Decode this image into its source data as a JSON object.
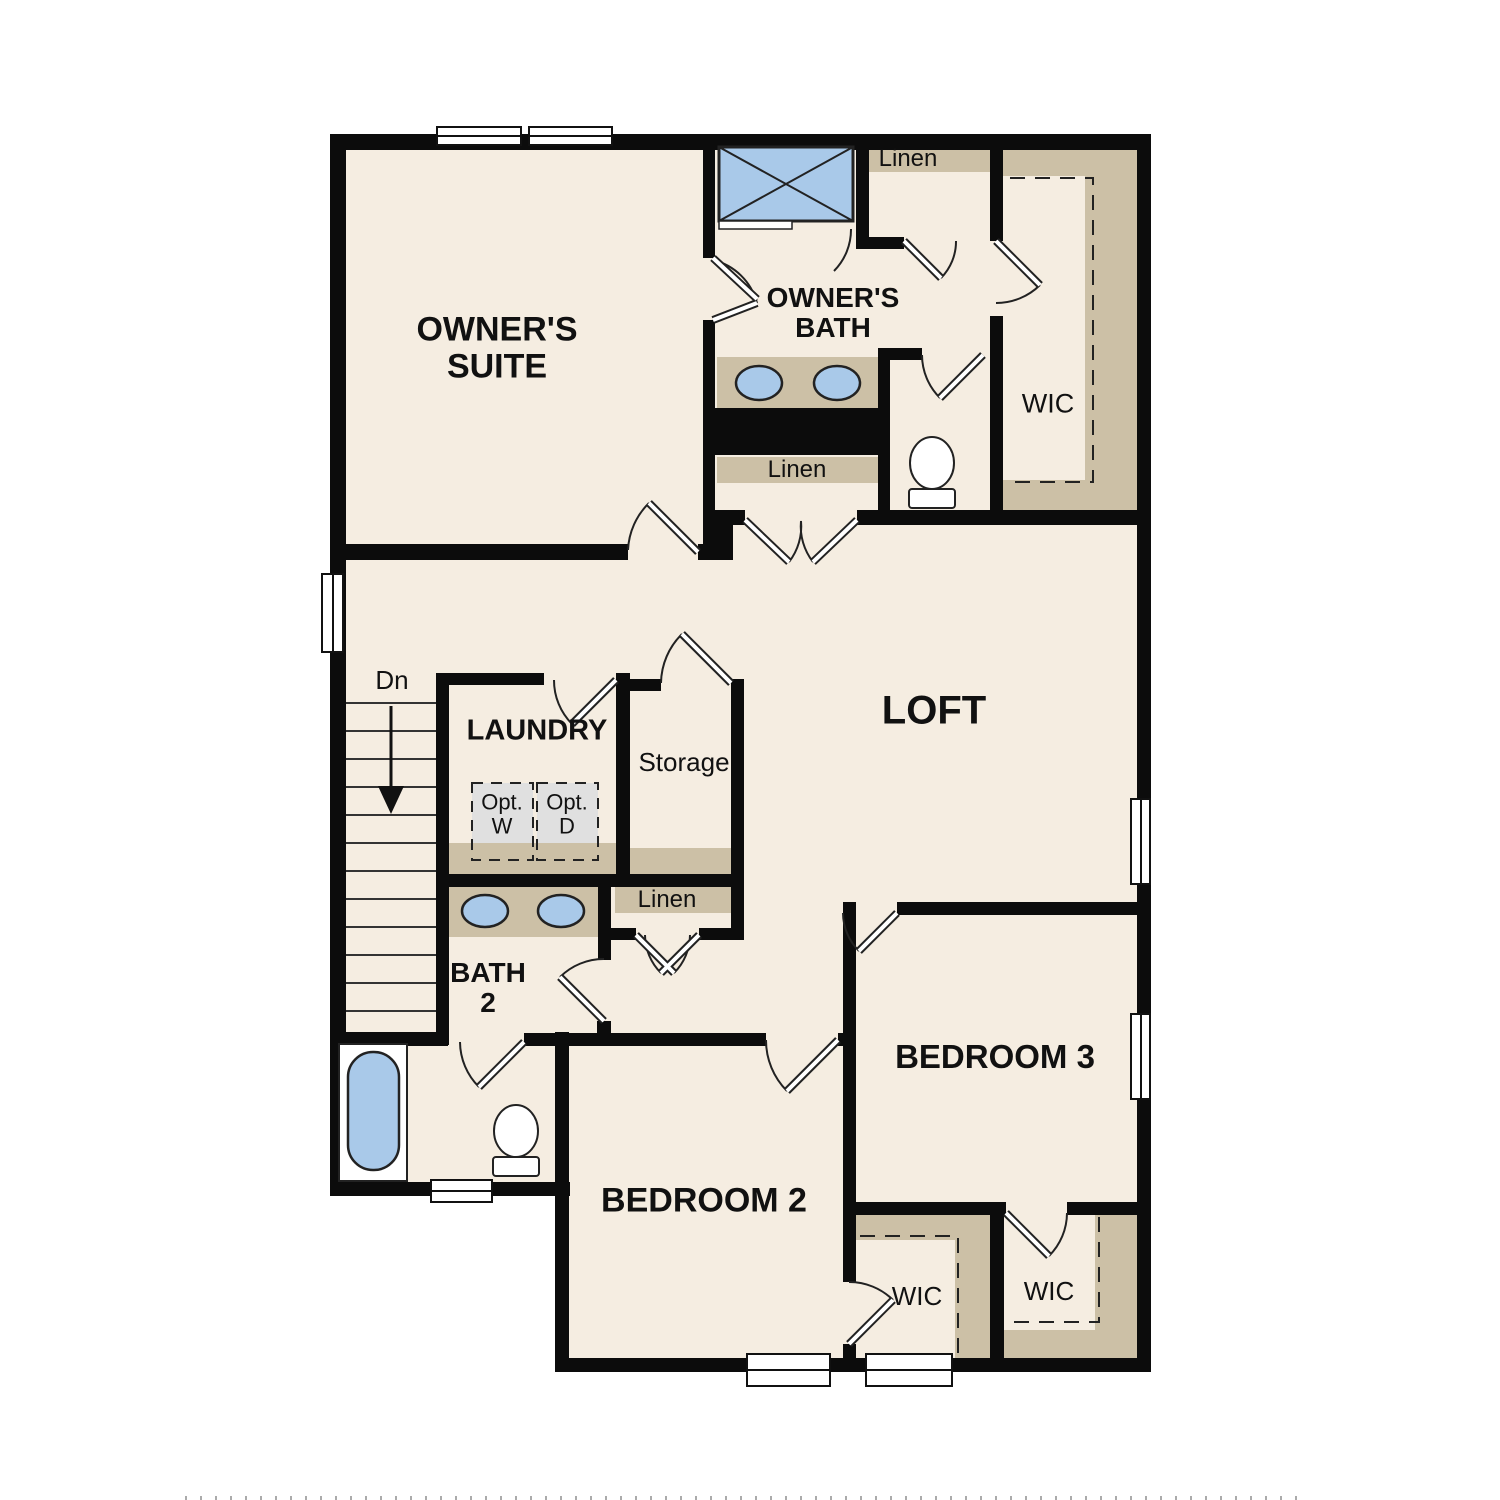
{
  "plan": {
    "type": "floor-plan",
    "labels": {
      "owners_suite": {
        "line1": "OWNER'S",
        "line2": "SUITE"
      },
      "owners_bath": {
        "line1": "OWNER'S",
        "line2": "BATH"
      },
      "wic_owners": "WIC",
      "linen_upper": "Linen",
      "linen_bath": "Linen",
      "linen_hall": "Linen",
      "loft": "LOFT",
      "laundry": "LAUNDRY",
      "storage": "Storage",
      "opt_washer": {
        "line1": "Opt.",
        "line2": "W"
      },
      "opt_dryer": {
        "line1": "Opt.",
        "line2": "D"
      },
      "bath2": {
        "line1": "BATH",
        "line2": "2"
      },
      "bedroom2": "BEDROOM 2",
      "bedroom3": "BEDROOM 3",
      "wic_bedroom2": "WIC",
      "wic_bedroom3": "WIC",
      "stairs_down": "Dn"
    },
    "colors": {
      "floor": "#f5ede1",
      "wall": "#0c0c0c",
      "cabinet_tan": "#ccc0a6",
      "fixture_blue": "#a9c9e9",
      "appliance_gray": "#e0e0e0",
      "line": "#222222",
      "background": "#ffffff"
    }
  }
}
